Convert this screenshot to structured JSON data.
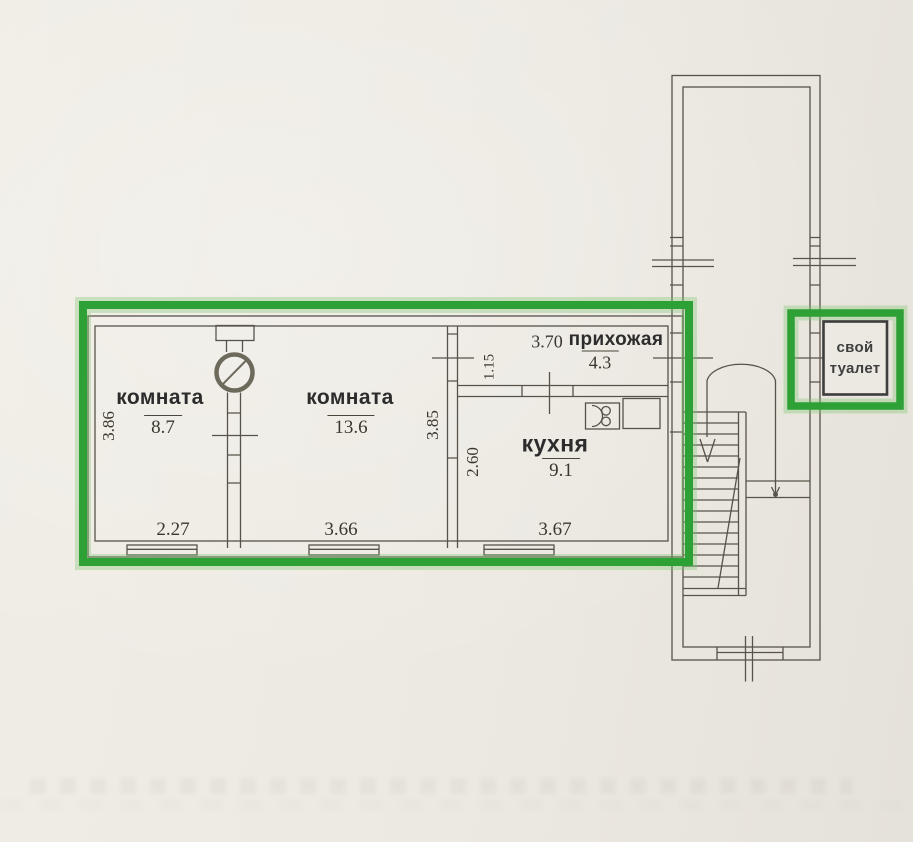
{
  "colors": {
    "paper": "#ECE9E2",
    "ink": "#57534A",
    "label_text": "#2C2C2C",
    "number_text": "#3A372E",
    "highlight_green": "#2DA036",
    "annotation_border": "#3D3D3D"
  },
  "rooms": {
    "room1": {
      "label": "комната",
      "area": "8.7",
      "width": "2.27",
      "height": "3.86"
    },
    "room2": {
      "label": "комната",
      "area": "13.6",
      "width": "3.66",
      "height": "3.85"
    },
    "kitchen": {
      "label": "кухня",
      "area": "9.1",
      "width": "3.67",
      "height": "2.60"
    },
    "hallway": {
      "label": "прихожая",
      "area": "4.3",
      "width": "3.70",
      "height": "1.15"
    }
  },
  "annotation": {
    "line1": "свой",
    "line2": "туалет"
  },
  "icons": [
    "furnace-icon",
    "stove-icon",
    "window-symbol",
    "stairs-symbol",
    "stair-down-arrow",
    "entry-path-arrow",
    "highlight-frame"
  ]
}
